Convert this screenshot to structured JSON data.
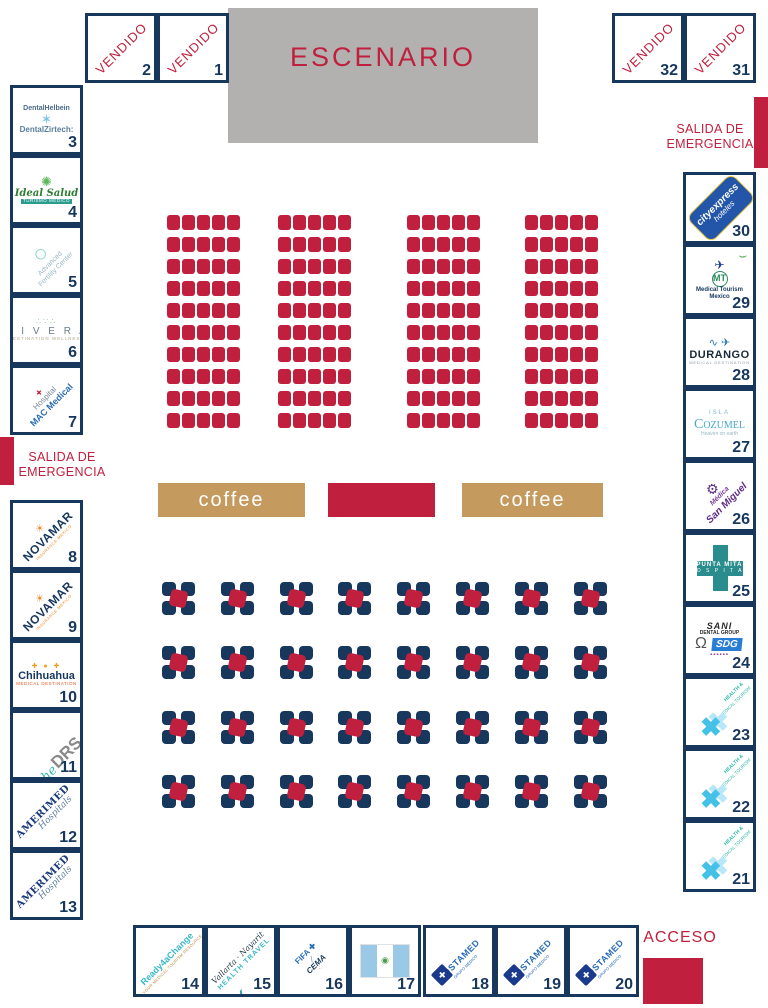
{
  "stage": {
    "label": "ESCENARIO"
  },
  "signs": {
    "vendido": "VENDIDO",
    "salida": "SALIDA DE EMERGENCIA",
    "acceso": "ACCESO",
    "coffee": "coffee"
  },
  "colors": {
    "crimson": "#c0203e",
    "navy": "#17375d",
    "tan": "#c49a5e",
    "stage_gray": "#b3b0b0"
  },
  "vendido_booths": [
    {
      "number": "2"
    },
    {
      "number": "1"
    },
    {
      "number": "32"
    },
    {
      "number": "31"
    }
  ],
  "booths": {
    "left": [
      {
        "number": "3",
        "brand": "dental-helbein-zirtech",
        "lines": [
          {
            "t": "DentalHelbein",
            "c": "helbein"
          },
          {
            "t": "✶",
            "c": "ic-zirtooth",
            "n": "tooth-mesh-icon"
          },
          {
            "t": "DentalZirtech:",
            "c": "zirtech"
          }
        ]
      },
      {
        "number": "4",
        "brand": "ideal-salud",
        "lines": [
          {
            "t": "✺",
            "c": "ic-ideal",
            "n": "ideal-salud-icon"
          },
          {
            "t": "Ideal Salud",
            "c": "ideal"
          },
          {
            "t": "TURISMO MÉDICO",
            "c": "ideal-sub"
          }
        ]
      },
      {
        "number": "5",
        "brand": "advanced-fertility-center",
        "logoCls": "lg-rot",
        "lines": [
          {
            "t": "○",
            "c": "ic-ring",
            "n": "ring-icon"
          },
          {
            "t": "Advanced",
            "c": "afc1"
          },
          {
            "t": "Fertility Center",
            "c": "afc2"
          }
        ]
      },
      {
        "number": "6",
        "brand": "mivera",
        "lines": [
          {
            "t": "∴∵∴",
            "c": "ic-dots",
            "n": "sparkle-dots-icon"
          },
          {
            "t": "M I V E R A",
            "c": "mivera"
          },
          {
            "t": "DESTINATION WELLNESS",
            "c": "mivera-sub"
          }
        ]
      },
      {
        "number": "7",
        "brand": "hospital-mac-medical",
        "logoCls": "lg-rot",
        "lines": [
          {
            "t": "✚",
            "c": "ic-maccross",
            "n": "red-cross-icon"
          },
          {
            "t": "Hospital",
            "c": "mac1"
          },
          {
            "t": "MAC Medical",
            "c": "mac2"
          }
        ]
      },
      {
        "number": "8",
        "brand": "novamar",
        "logoCls": "lg-rot",
        "lines": [
          {
            "t": "☀",
            "c": "ic-sun",
            "n": "sun-icon"
          },
          {
            "t": "NOVAMAR",
            "c": "nvm"
          },
          {
            "t": "INSURANCE MEXICO",
            "c": "nvm-sub"
          }
        ]
      },
      {
        "number": "9",
        "brand": "novamar",
        "logoCls": "lg-rot",
        "lines": [
          {
            "t": "☀",
            "c": "ic-sun",
            "n": "sun-icon"
          },
          {
            "t": "NOVAMAR",
            "c": "nvm"
          },
          {
            "t": "INSURANCE MEXICO",
            "c": "nvm-sub"
          }
        ]
      },
      {
        "number": "10",
        "brand": "chihuahua-medical-destination",
        "lines": [
          {
            "t": "✚ ● ✚",
            "c": "chi-dots",
            "n": "colored-dots-icon"
          },
          {
            "t": "Chihuahua",
            "c": "chi"
          },
          {
            "t": "MEDICAL DESTINATION",
            "c": "chi-sub"
          }
        ]
      },
      {
        "number": "11",
        "brand": "the-drs",
        "logoCls": "lg-rot lg-row",
        "lines": [
          {
            "t": "the",
            "c": "drs-the"
          },
          {
            "t": "DRS.",
            "c": "drs"
          }
        ]
      },
      {
        "number": "12",
        "brand": "amerimed-hospitals",
        "logoCls": "lg-rot",
        "lines": [
          {
            "t": "AMERIMED",
            "c": "amer1"
          },
          {
            "t": "Hospitals",
            "c": "amer2"
          }
        ]
      },
      {
        "number": "13",
        "brand": "amerimed-hospitals",
        "logoCls": "lg-rot",
        "lines": [
          {
            "t": "AMERIMED",
            "c": "amer1"
          },
          {
            "t": "Hospitals",
            "c": "amer2"
          }
        ]
      }
    ],
    "right": [
      {
        "number": "30",
        "brand": "city-express-hoteles",
        "logoCls": "lg-cityexpress",
        "lines": [
          {
            "t": "cityexpress",
            "c": "cx1"
          },
          {
            "t": "hoteles",
            "c": "cx2"
          }
        ]
      },
      {
        "number": "29",
        "brand": "medical-tourism-mexico",
        "lines": [
          {
            "t": "✈",
            "c": "ic-plane",
            "n": "plane-icon"
          },
          {
            "t": "⌣",
            "c": "ic-steth",
            "n": "stethoscope-icon"
          },
          {
            "t": "MT",
            "c": "mt-badge",
            "n": "mt-monogram"
          },
          {
            "t": "Medical Tourism",
            "c": "mtm"
          },
          {
            "t": "Mexico",
            "c": "mtm"
          }
        ]
      },
      {
        "number": "28",
        "brand": "durango-medical-destination",
        "lines": [
          {
            "t": "∿ ✈",
            "c": "ic-hb",
            "n": "heartbeat-plane-icon"
          },
          {
            "t": "DURANGO",
            "c": "durango"
          },
          {
            "t": "MEDICAL DESTINATION",
            "c": "dur-sub"
          }
        ]
      },
      {
        "number": "27",
        "brand": "isla-cozumel",
        "lines": [
          {
            "t": "ISLA",
            "c": "coz1"
          },
          {
            "t": "Cozumel",
            "c": "coz2"
          },
          {
            "t": "Heaven on earth",
            "c": "coz3"
          }
        ]
      },
      {
        "number": "26",
        "brand": "medica-san-miguel",
        "logoCls": "lg-rot",
        "lines": [
          {
            "t": "⚙",
            "c": "ic-gear",
            "n": "gear-icon"
          },
          {
            "t": "Médica",
            "c": "smg1"
          },
          {
            "t": "San Miguel",
            "c": "smg2"
          }
        ]
      },
      {
        "number": "25",
        "brand": "punta-mita-hospital",
        "logoCls": "lg-puntamita",
        "lines": [
          {
            "t": "PUNTA MITA",
            "c": "pm1"
          },
          {
            "t": "H O S P I T A L",
            "c": "pm2"
          }
        ]
      },
      {
        "number": "24",
        "brand": "sani-dental-group",
        "lines": [
          {
            "t": "SANI",
            "c": "sani1"
          },
          {
            "t": "DENTAL GROUP",
            "c": "sani2"
          },
          {
            "t": "SDG",
            "c": "sdg"
          },
          {
            "t": "▪▪▪▪▪▪",
            "c": "sani-sq",
            "n": "purple-squares"
          },
          {
            "t": "Ω",
            "c": "ic-tooth",
            "n": "tooth-icon"
          }
        ]
      },
      {
        "number": "23",
        "brand": "health-medical-tourism",
        "lines": [
          {
            "t": "HEALTH &",
            "c": "hmt1"
          },
          {
            "t": "MEDICAL TOURISM",
            "c": "hmt2"
          },
          {
            "t": "✖",
            "c": "ic-hmt",
            "n": "blue-cross-x-icon"
          }
        ]
      },
      {
        "number": "22",
        "brand": "health-medical-tourism",
        "lines": [
          {
            "t": "HEALTH &",
            "c": "hmt1"
          },
          {
            "t": "MEDICAL TOURISM",
            "c": "hmt2"
          },
          {
            "t": "✖",
            "c": "ic-hmt",
            "n": "blue-cross-x-icon"
          }
        ]
      },
      {
        "number": "21",
        "brand": "health-medical-tourism",
        "lines": [
          {
            "t": "HEALTH &",
            "c": "hmt1"
          },
          {
            "t": "MEDICAL TOURISM",
            "c": "hmt2"
          },
          {
            "t": "✖",
            "c": "ic-hmt",
            "n": "blue-cross-x-icon"
          }
        ]
      }
    ],
    "bottom": [
      {
        "number": "14",
        "brand": "ready4achange",
        "logoCls": "lg-rot",
        "lines": [
          {
            "t": "Ready4aChange",
            "c": "r4c1"
          },
          {
            "t": "YOUR MEDICAL TOURISM RESOURCE",
            "c": "r4c2"
          }
        ]
      },
      {
        "number": "15",
        "brand": "vallarta-nayarit-health-travel",
        "logoCls": "lg-rot",
        "lines": [
          {
            "t": "Vallarta · Nayarit",
            "c": "vn1"
          },
          {
            "t": "HEALTH TRAVEL",
            "c": "vn2"
          },
          {
            "t": "⋎",
            "c": "ic-whale",
            "n": "whale-tail-icon"
          }
        ]
      },
      {
        "number": "16",
        "brand": "cema-fifa",
        "logoCls": "lg-rot",
        "lines": [
          {
            "t": "FIFA ✚",
            "c": "fifa"
          },
          {
            "t": "/",
            "c": "slash"
          },
          {
            "t": "CEMA",
            "c": "cema"
          },
          {
            "t": "⁖",
            "c": "cema-ic",
            "n": "cema-icon"
          }
        ]
      },
      {
        "number": "17",
        "brand": "guatemala-flag",
        "logoCls": "lg-flag",
        "lines": [
          {
            "t": "◉",
            "c": "gt-emblem",
            "n": "guatemala-emblem"
          }
        ]
      },
      {
        "number": "18",
        "brand": "costamed-grupo-medico",
        "lines": [
          {
            "t": "COSTAMED",
            "c": "cm1"
          },
          {
            "t": "GRUPO MÉDICO",
            "c": "cm2"
          },
          {
            "t": "✚",
            "c": "ic-cm",
            "n": "costamed-diamond-icon"
          }
        ]
      },
      {
        "number": "19",
        "brand": "costamed-grupo-medico",
        "lines": [
          {
            "t": "COSTAMED",
            "c": "cm1"
          },
          {
            "t": "GRUPO MÉDICO",
            "c": "cm2"
          },
          {
            "t": "✚",
            "c": "ic-cm",
            "n": "costamed-diamond-icon"
          }
        ]
      },
      {
        "number": "20",
        "brand": "costamed-grupo-medico",
        "lines": [
          {
            "t": "COSTAMED",
            "c": "cm1"
          },
          {
            "t": "GRUPO MÉDICO",
            "c": "cm2"
          },
          {
            "t": "✚",
            "c": "ic-cm",
            "n": "costamed-diamond-icon"
          }
        ]
      }
    ]
  },
  "seating": {
    "blocks": 4,
    "rows": 10,
    "cols": 5
  },
  "tables": {
    "rows": 4,
    "cols": 8
  }
}
